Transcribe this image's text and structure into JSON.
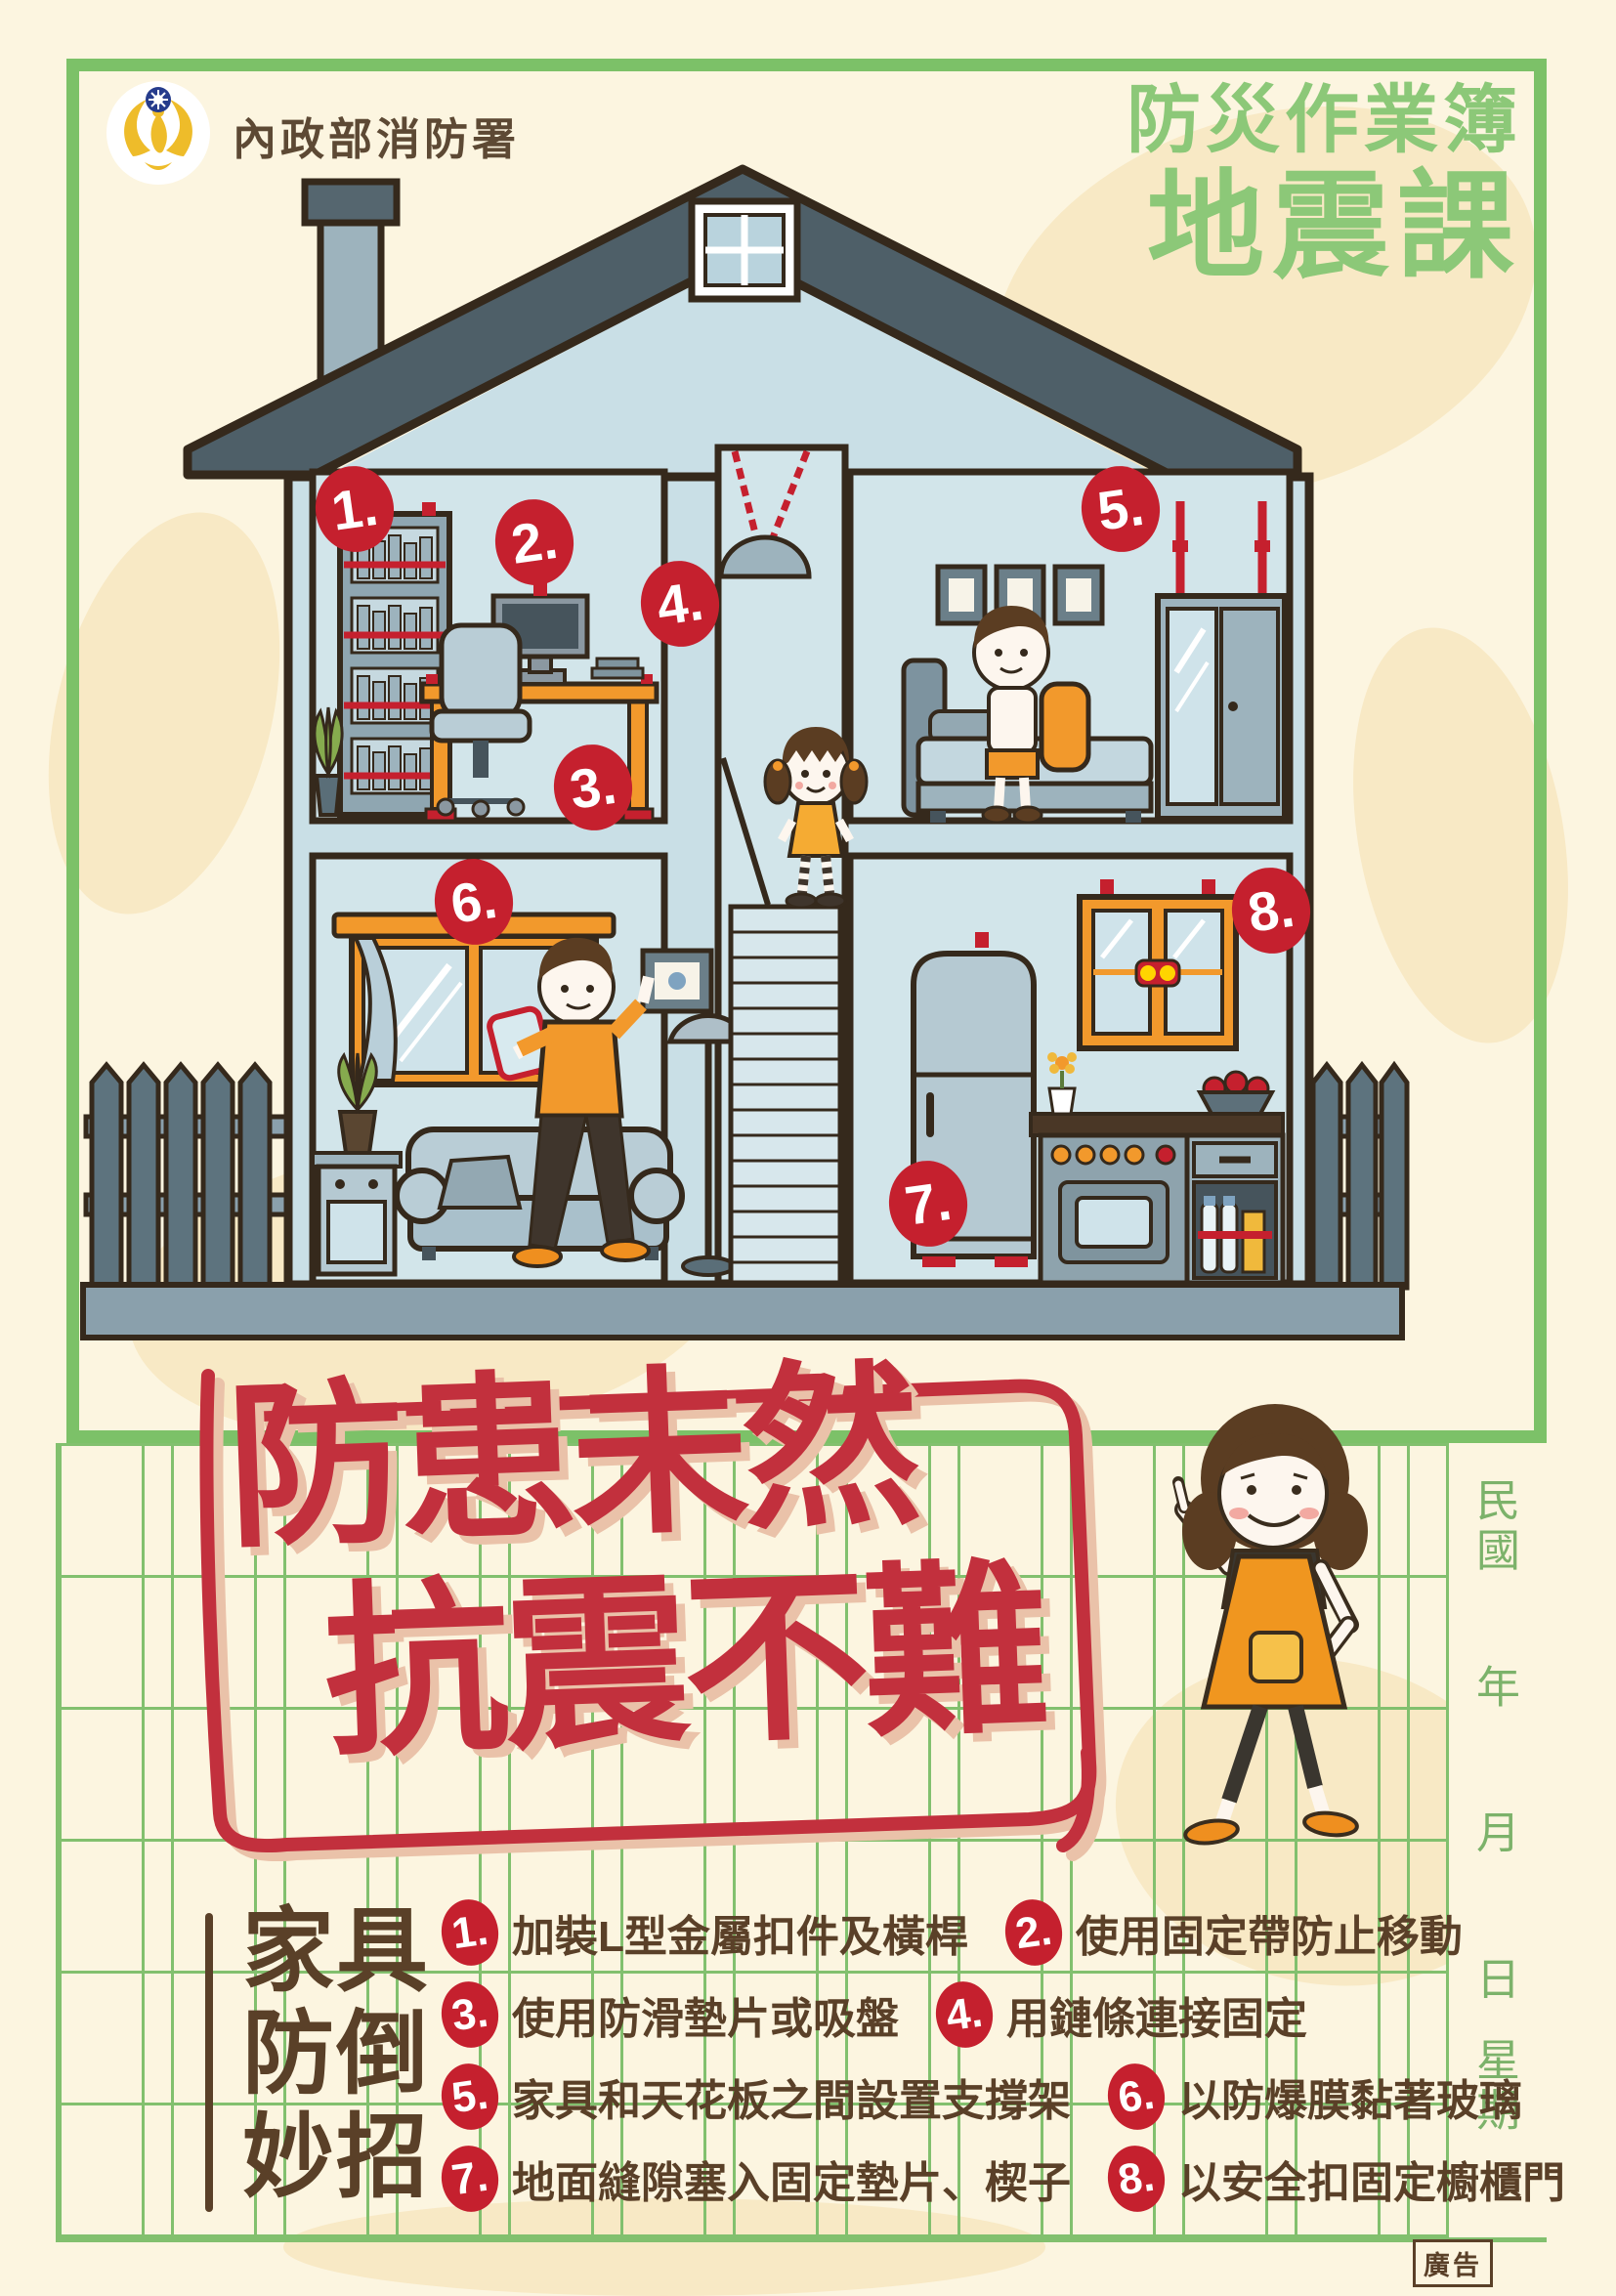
{
  "header": {
    "agency": "內政部消防署",
    "series_title": "防災作業簿",
    "course_title": "地震課"
  },
  "house_markers": [
    "1.",
    "2.",
    "3.",
    "4.",
    "5.",
    "6.",
    "7.",
    "8."
  ],
  "slogan": {
    "line1": "防患未然",
    "line2": "抗震不難"
  },
  "date_column": {
    "era": "民國",
    "year": "年",
    "month": "月",
    "day": "日",
    "weekday": "星期"
  },
  "tips_section": {
    "heading_lines": [
      "家具",
      "防倒",
      "妙招"
    ],
    "tips": [
      {
        "num": "1.",
        "text": "加裝L型金屬扣件及橫桿"
      },
      {
        "num": "2.",
        "text": "使用固定帶防止移動"
      },
      {
        "num": "3.",
        "text": "使用防滑墊片或吸盤"
      },
      {
        "num": "4.",
        "text": "用鏈條連接固定"
      },
      {
        "num": "5.",
        "text": "家具和天花板之間設置支撐架"
      },
      {
        "num": "6.",
        "text": "以防爆膜黏著玻璃"
      },
      {
        "num": "7.",
        "text": "地面縫隙塞入固定墊片、楔子"
      },
      {
        "num": "8.",
        "text": "以安全扣固定櫥櫃門"
      }
    ]
  },
  "footer": {
    "ad_label": "廣告"
  },
  "colors": {
    "frame_green": "#7cc168",
    "title_green": "#8cc878",
    "marker_red": "#c5202e",
    "slogan_red": "#c2303d",
    "text_brown": "#5a4028",
    "accent_orange": "#f2992c",
    "wall_blue": "#c9dfe6",
    "paper_cream": "#fcf5e0"
  }
}
